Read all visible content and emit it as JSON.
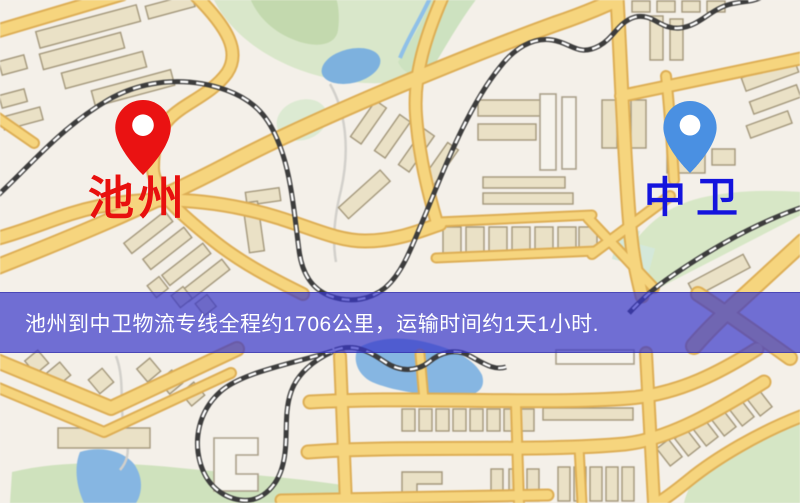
{
  "map": {
    "origin": {
      "label": "池州",
      "pin_color": "#ea1212",
      "label_color": "#e8100e"
    },
    "destination": {
      "label": "中卫",
      "pin_color": "#4a90e2",
      "label_color": "#1414dd"
    },
    "banner": {
      "text": "池州到中卫物流专线全程约1706公里，运输时间约1天1小时.",
      "distance_km": "1706",
      "duration": "1天1小时",
      "bg_color": "rgba(56,54,201,0.70)",
      "text_color": "#ffffff"
    },
    "style_colors": {
      "background": "#f4f0e9",
      "road": "#f6d57e",
      "park": "#d7e7c6",
      "water": "#86b6e2",
      "railway": "#3c3c3c"
    }
  }
}
